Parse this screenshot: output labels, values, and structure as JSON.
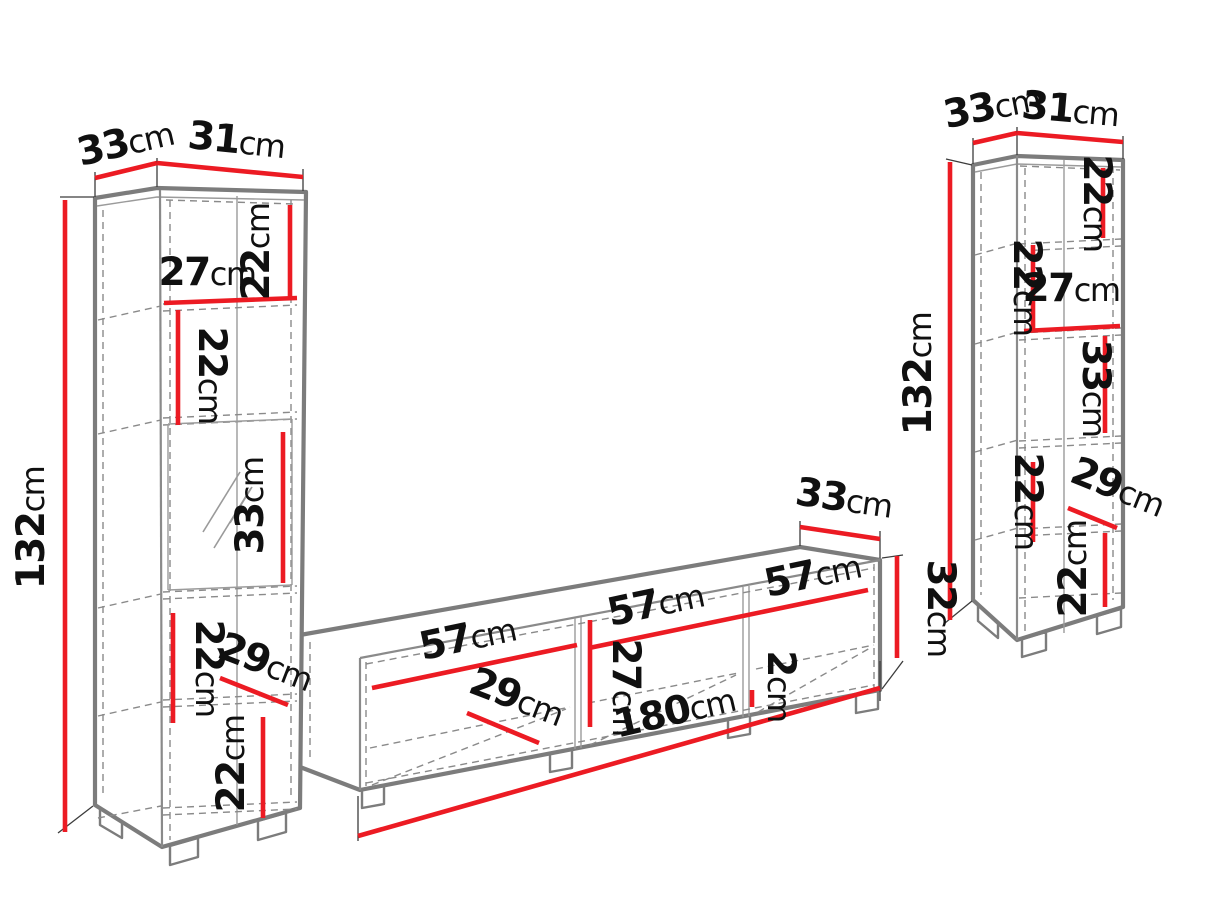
{
  "colors": {
    "dimension_red": "#ec1b23",
    "outline_gray": "#7c7c7c",
    "text_black": "#101010"
  },
  "left_cabinet": {
    "dims": {
      "top_depth": {
        "num": "33",
        "unit": "cm"
      },
      "top_width": {
        "num": "31",
        "unit": "cm"
      },
      "height": {
        "num": "132",
        "unit": "cm"
      },
      "section1_height": {
        "num": "22",
        "unit": "cm"
      },
      "inner_width": {
        "num": "27",
        "unit": "cm"
      },
      "section2_height": {
        "num": "22",
        "unit": "cm"
      },
      "glass_height": {
        "num": "33",
        "unit": "cm"
      },
      "section4_height": {
        "num": "22",
        "unit": "cm"
      },
      "inner_depth": {
        "num": "29",
        "unit": "cm"
      },
      "section5_height": {
        "num": "22",
        "unit": "cm"
      }
    }
  },
  "tv_stand": {
    "dims": {
      "compartment1_width": {
        "num": "57",
        "unit": "cm"
      },
      "compartment2_width": {
        "num": "57",
        "unit": "cm"
      },
      "compartment3_width": {
        "num": "57",
        "unit": "cm"
      },
      "inner_height": {
        "num": "27",
        "unit": "cm"
      },
      "inner_depth": {
        "num": "29",
        "unit": "cm"
      },
      "total_length": {
        "num": "180",
        "unit": "cm"
      },
      "base_height": {
        "num": "2",
        "unit": "cm"
      },
      "top_depth": {
        "num": "33",
        "unit": "cm"
      },
      "height": {
        "num": "32",
        "unit": "cm"
      }
    }
  },
  "right_cabinet": {
    "dims": {
      "top_depth": {
        "num": "33",
        "unit": "cm"
      },
      "top_width": {
        "num": "31",
        "unit": "cm"
      },
      "height": {
        "num": "132",
        "unit": "cm"
      },
      "section1_height": {
        "num": "22",
        "unit": "cm"
      },
      "section2_height": {
        "num": "22",
        "unit": "cm"
      },
      "inner_width": {
        "num": "27",
        "unit": "cm"
      },
      "section3_height": {
        "num": "33",
        "unit": "cm"
      },
      "section4_height": {
        "num": "22",
        "unit": "cm"
      },
      "inner_depth": {
        "num": "29",
        "unit": "cm"
      },
      "section5_height": {
        "num": "22",
        "unit": "cm"
      }
    }
  }
}
